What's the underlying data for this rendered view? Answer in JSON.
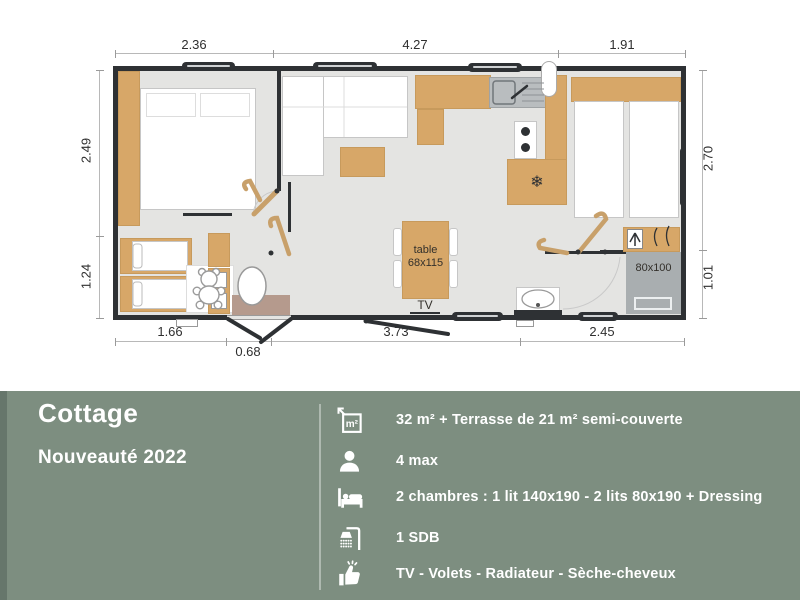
{
  "plan": {
    "dimensions": {
      "top": [
        "2.36",
        "4.27",
        "1.91"
      ],
      "left": [
        "2.49",
        "1.24"
      ],
      "right": [
        "2.70",
        "1.01"
      ],
      "bottom": [
        "1.66",
        "3.73",
        "2.45"
      ],
      "bottom_door": [
        "0.68"
      ]
    },
    "labels": {
      "table_name": "table",
      "table_size": "68x115",
      "tv": "TV",
      "shower_size": "80x100"
    },
    "icons": {
      "fridge": "snowflake-icon",
      "fridge_glyph": "❄"
    },
    "colors": {
      "wall": "#2e3134",
      "wood": "#d7a768",
      "floor": "#e4e4e2",
      "shower": "#a9aeb0"
    }
  },
  "panel": {
    "title": "Cottage",
    "subtitle": "Nouveauté 2022",
    "colors": {
      "background": "#7d8e80",
      "left_strip": "#66766b",
      "text": "#ffffff"
    },
    "specs": [
      {
        "icon": "area-icon",
        "text": "32 m²  + Terrasse de 21 m² semi-couverte"
      },
      {
        "icon": "person-icon",
        "text": "4 max"
      },
      {
        "icon": "bed-icon",
        "text": "2 chambres : 1 lit 140x190 - 2 lits 80x190 + Dressing"
      },
      {
        "icon": "shower-icon",
        "text": "1 SDB"
      },
      {
        "icon": "thumbs-up-icon",
        "text": "TV - Volets - Radiateur - Sèche-cheveux"
      }
    ]
  }
}
